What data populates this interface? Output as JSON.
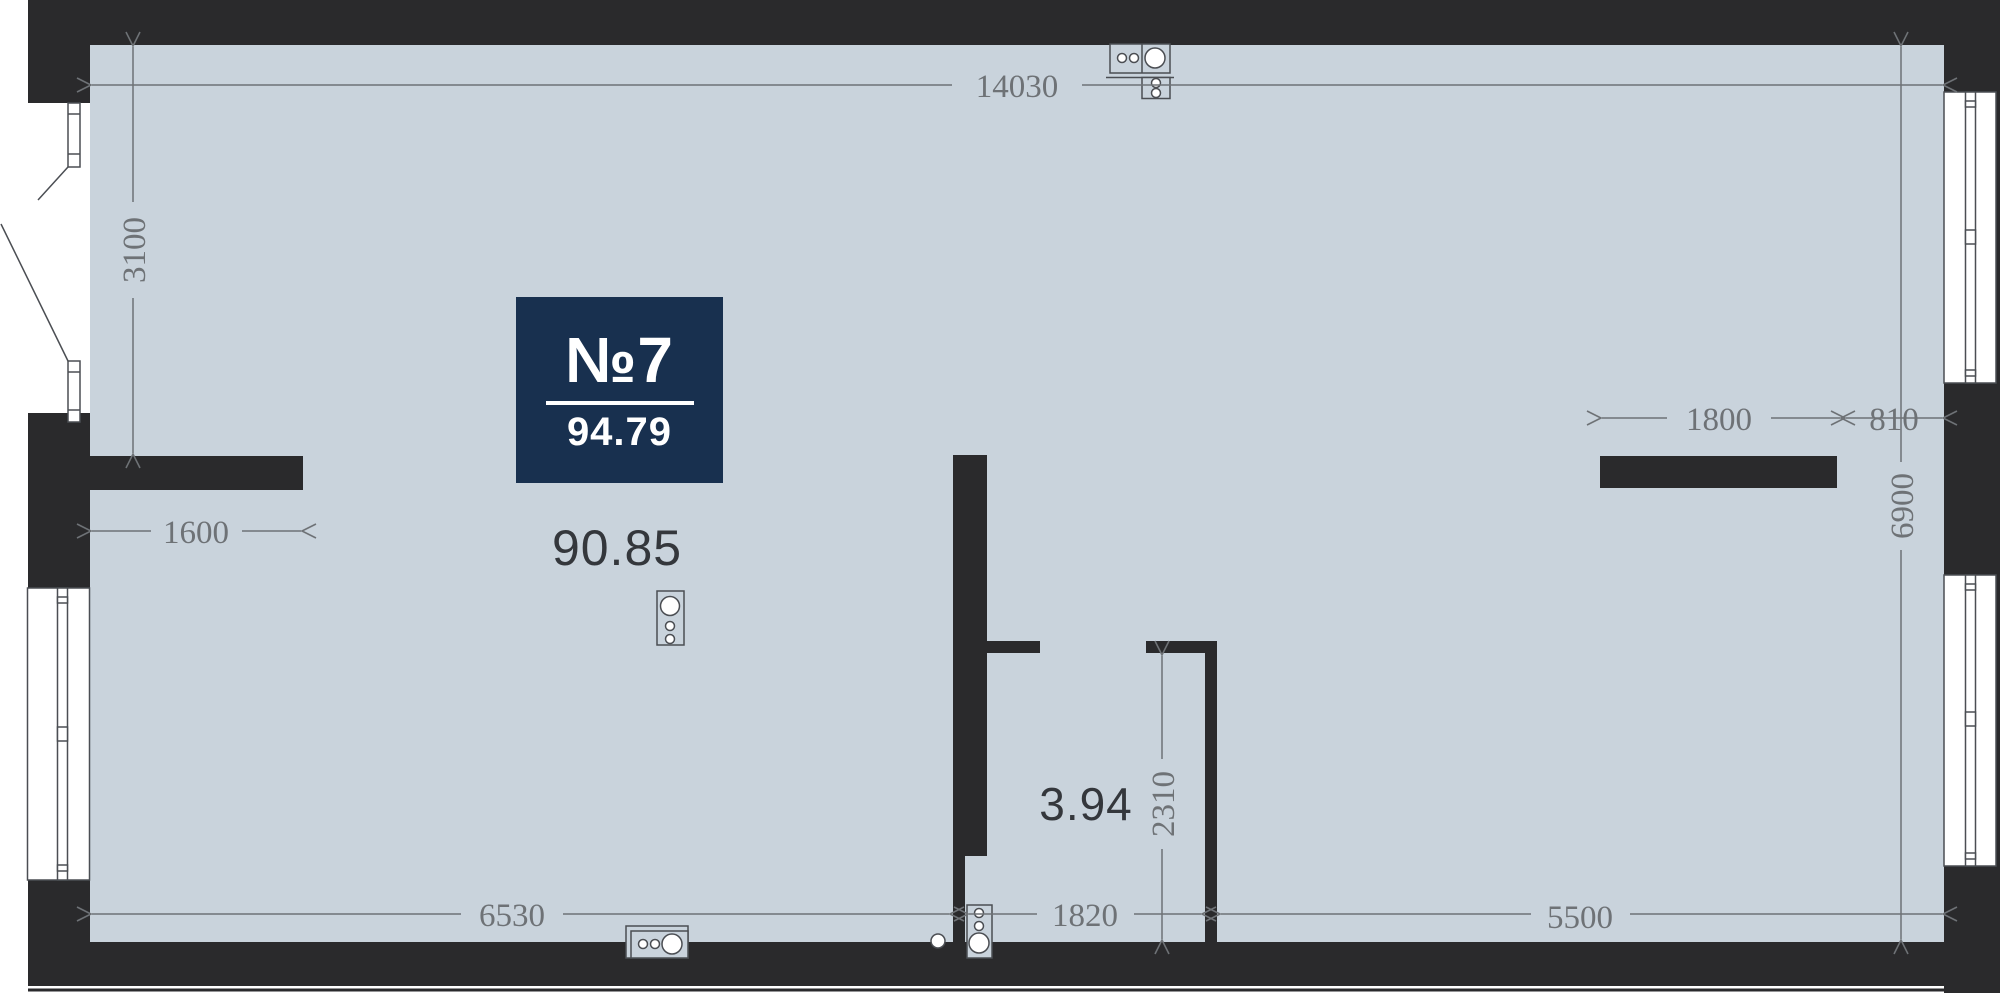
{
  "plan": {
    "badge": {
      "number": "№7",
      "total_area": "94.79"
    },
    "room_areas": {
      "main": "90.85",
      "hall": "3.94"
    },
    "dimensions": {
      "top_width": "14030",
      "left_height": "3100",
      "niche_width": "1600",
      "bottom_left": "6530",
      "bottom_center": "1820",
      "bottom_right": "5500",
      "hall_height": "2310",
      "wardrobe_width": "1800",
      "wardrobe_offset": "810",
      "right_height": "6900"
    },
    "colors": {
      "floor": "#c9d3dc",
      "wall": "#2a2a2c",
      "dimension": "#6e7276",
      "badge_bg": "#18304f",
      "area_text": "#34373c",
      "symbol_stroke": "#4b4e53"
    }
  }
}
